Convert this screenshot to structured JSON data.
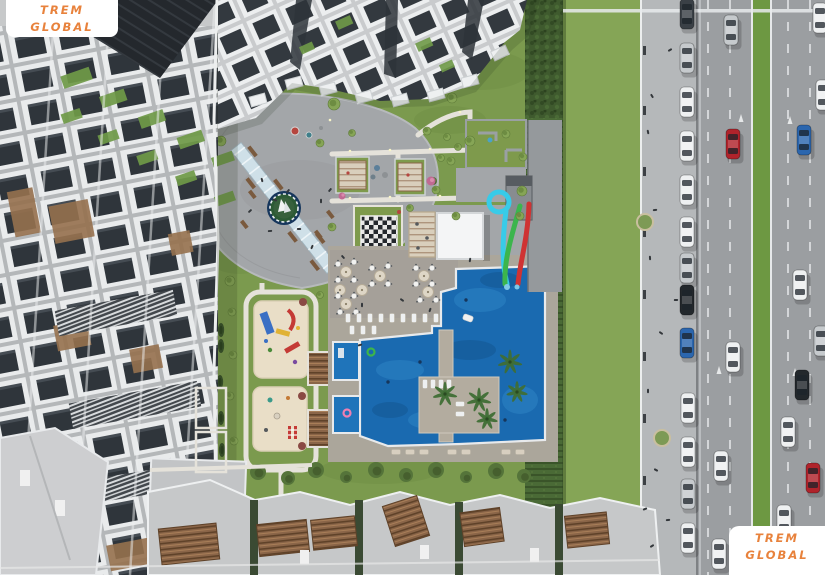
{
  "meta": {
    "description": "Aerial 3D architectural render of a residential complex: apartment blocks, landscaped courtyard with central plaza, chess board, playgrounds, cafe terrace, large swimming pool with water slides, hedge, sidewalk and multi-lane road with traffic",
    "width": 825,
    "height": 575
  },
  "watermarks": {
    "text_color": "#E8823C",
    "background": "#FFFFFF",
    "top_left": {
      "line1": "TREM",
      "line2": "GLOBAL"
    },
    "bottom_right": {
      "line1": "TREM",
      "line2": "GLOBAL"
    }
  },
  "palette": {
    "grass": "#7B9A4E",
    "grass_strip": "#85A556",
    "hedge": "#3F5A2E",
    "plaza": "#A3A6A9",
    "deck": "#ABA69B",
    "road": "#9B9EA1",
    "sidewalk": "#B5B8BA",
    "median": "#6D9842",
    "pool": "#1A6AB0",
    "slide_cyan": "#38CBE8",
    "slide_green": "#3CB54D",
    "slide_red": "#CF3333",
    "playground_sand": "#E9DEC7",
    "pergola_wood": "#8A6548",
    "car_colors": {
      "white": "#EEF0F1",
      "silver": "#C6CACD",
      "dark": "#3A4046",
      "black": "#23282C",
      "red": "#B0232B",
      "blue": "#2B66AE"
    }
  },
  "scene": {
    "cars": [
      {
        "x": 687,
        "y": 14,
        "c": "dark"
      },
      {
        "x": 687,
        "y": 58,
        "c": "silver"
      },
      {
        "x": 687,
        "y": 102,
        "c": "white"
      },
      {
        "x": 687,
        "y": 146,
        "c": "white"
      },
      {
        "x": 687,
        "y": 190,
        "c": "white"
      },
      {
        "x": 687,
        "y": 232,
        "c": "white"
      },
      {
        "x": 687,
        "y": 268,
        "c": "silver"
      },
      {
        "x": 687,
        "y": 300,
        "c": "black"
      },
      {
        "x": 687,
        "y": 343,
        "c": "blue"
      },
      {
        "x": 688,
        "y": 408,
        "c": "white"
      },
      {
        "x": 688,
        "y": 452,
        "c": "white"
      },
      {
        "x": 688,
        "y": 494,
        "c": "silver"
      },
      {
        "x": 688,
        "y": 538,
        "c": "white"
      },
      {
        "x": 731,
        "y": 30,
        "c": "silver"
      },
      {
        "x": 733,
        "y": 144,
        "c": "red"
      },
      {
        "x": 733,
        "y": 357,
        "c": "white"
      },
      {
        "x": 721,
        "y": 466,
        "c": "white"
      },
      {
        "x": 719,
        "y": 554,
        "c": "white"
      },
      {
        "x": 820,
        "y": 18,
        "c": "white"
      },
      {
        "x": 823,
        "y": 95,
        "c": "white"
      },
      {
        "x": 804,
        "y": 140,
        "c": "blue"
      },
      {
        "x": 800,
        "y": 285,
        "c": "white"
      },
      {
        "x": 821,
        "y": 341,
        "c": "silver"
      },
      {
        "x": 802,
        "y": 385,
        "c": "black"
      },
      {
        "x": 788,
        "y": 432,
        "c": "white"
      },
      {
        "x": 813,
        "y": 478,
        "c": "red"
      },
      {
        "x": 784,
        "y": 520,
        "c": "white"
      }
    ],
    "trees": [
      {
        "t": "tree",
        "x": 238,
        "y": 99,
        "r": 6
      },
      {
        "t": "tree",
        "x": 221,
        "y": 141,
        "r": 5
      },
      {
        "t": "tree",
        "x": 205,
        "y": 189,
        "r": 5
      },
      {
        "t": "tree",
        "x": 205,
        "y": 247,
        "r": 5
      },
      {
        "t": "tree",
        "x": 230,
        "y": 281,
        "r": 5
      },
      {
        "t": "tree",
        "x": 334,
        "y": 104,
        "r": 6
      },
      {
        "t": "tree",
        "x": 362,
        "y": 96,
        "r": 5
      },
      {
        "t": "tree",
        "x": 452,
        "y": 98,
        "r": 5
      },
      {
        "t": "tree",
        "x": 470,
        "y": 141,
        "r": 5
      },
      {
        "t": "tree",
        "x": 506,
        "y": 134,
        "r": 4
      },
      {
        "t": "tree",
        "x": 523,
        "y": 157,
        "r": 4
      },
      {
        "t": "tree",
        "x": 451,
        "y": 161,
        "r": 4
      },
      {
        "t": "tree",
        "x": 436,
        "y": 190,
        "r": 4
      },
      {
        "t": "tree",
        "x": 522,
        "y": 191,
        "r": 5
      },
      {
        "t": "tree",
        "x": 456,
        "y": 216,
        "r": 4
      },
      {
        "t": "tree",
        "x": 520,
        "y": 216,
        "r": 4
      },
      {
        "t": "tree",
        "x": 332,
        "y": 227,
        "r": 4
      },
      {
        "t": "tree",
        "x": 410,
        "y": 208,
        "r": 3.5
      },
      {
        "t": "tree",
        "x": 427,
        "y": 131,
        "r": 4
      },
      {
        "t": "tree",
        "x": 447,
        "y": 137,
        "r": 3.5
      },
      {
        "t": "tree",
        "x": 458,
        "y": 147,
        "r": 3.5
      },
      {
        "t": "tree",
        "x": 441,
        "y": 158,
        "r": 3.5
      },
      {
        "t": "tree",
        "x": 320,
        "y": 143,
        "r": 4
      },
      {
        "t": "tree",
        "x": 352,
        "y": 133,
        "r": 3.5
      },
      {
        "t": "tree",
        "x": 232,
        "y": 312,
        "r": 4
      },
      {
        "t": "tree",
        "x": 233,
        "y": 355,
        "r": 4
      },
      {
        "t": "tree",
        "x": 230,
        "y": 396,
        "r": 4
      },
      {
        "t": "tree",
        "x": 234,
        "y": 441,
        "r": 4
      },
      {
        "t": "tree",
        "x": 320,
        "y": 295,
        "r": 3.5
      },
      {
        "t": "cypress",
        "x": 221,
        "y": 330,
        "r": 7
      },
      {
        "t": "cypress",
        "x": 221,
        "y": 346,
        "r": 7
      },
      {
        "t": "cypress",
        "x": 220,
        "y": 382,
        "r": 7
      },
      {
        "t": "cypress",
        "x": 221,
        "y": 418,
        "r": 7
      },
      {
        "t": "cypress",
        "x": 222,
        "y": 450,
        "r": 7
      },
      {
        "t": "cypress",
        "x": 243,
        "y": 513,
        "r": 8
      },
      {
        "t": "cypress",
        "x": 246,
        "y": 543,
        "r": 8
      },
      {
        "t": "bush",
        "x": 258,
        "y": 472,
        "r": 8
      },
      {
        "t": "bush",
        "x": 288,
        "y": 478,
        "r": 7
      },
      {
        "t": "bush",
        "x": 316,
        "y": 470,
        "r": 8
      },
      {
        "t": "bush",
        "x": 346,
        "y": 477,
        "r": 6
      },
      {
        "t": "bush",
        "x": 376,
        "y": 470,
        "r": 8
      },
      {
        "t": "bush",
        "x": 406,
        "y": 475,
        "r": 7
      },
      {
        "t": "bush",
        "x": 436,
        "y": 470,
        "r": 8
      },
      {
        "t": "bush",
        "x": 466,
        "y": 477,
        "r": 6
      },
      {
        "t": "bush",
        "x": 496,
        "y": 471,
        "r": 8
      },
      {
        "t": "bush",
        "x": 524,
        "y": 476,
        "r": 7
      },
      {
        "t": "palm",
        "x": 445,
        "y": 394,
        "r": 8
      },
      {
        "t": "palm",
        "x": 479,
        "y": 400,
        "r": 8
      },
      {
        "t": "palm",
        "x": 510,
        "y": 362,
        "r": 8
      },
      {
        "t": "palm",
        "x": 517,
        "y": 392,
        "r": 7
      },
      {
        "t": "palm",
        "x": 487,
        "y": 419,
        "r": 7
      },
      {
        "t": "sidewalktree",
        "x": 645,
        "y": 222,
        "r": 8
      },
      {
        "t": "sidewalktree",
        "x": 662,
        "y": 438,
        "r": 8
      },
      {
        "t": "bush",
        "x": 433,
        "y": 181,
        "r": 4
      },
      {
        "t": "pink",
        "x": 431,
        "y": 181,
        "r": 4.5
      },
      {
        "t": "pink",
        "x": 342,
        "y": 196,
        "r": 3.5
      }
    ],
    "people": [
      [
        262,
        180
      ],
      [
        275,
        200
      ],
      [
        299,
        229
      ],
      [
        312,
        247
      ],
      [
        288,
        191
      ],
      [
        270,
        231
      ],
      [
        321,
        201
      ],
      [
        250,
        211
      ],
      [
        330,
        190
      ],
      [
        343,
        257
      ],
      [
        362,
        305
      ],
      [
        402,
        300
      ],
      [
        430,
        310
      ],
      [
        470,
        260
      ],
      [
        360,
        345
      ],
      [
        652,
        96
      ],
      [
        648,
        132
      ],
      [
        655,
        210
      ],
      [
        650,
        258
      ],
      [
        661,
        333
      ],
      [
        648,
        391
      ],
      [
        656,
        470
      ],
      [
        645,
        509
      ],
      [
        652,
        546
      ],
      [
        670,
        50
      ],
      [
        676,
        300
      ],
      [
        668,
        520
      ]
    ],
    "cafe_tables": [
      [
        338,
        264
      ],
      [
        354,
        262
      ],
      [
        338,
        280
      ],
      [
        354,
        280
      ],
      [
        338,
        296
      ],
      [
        354,
        296
      ],
      [
        340,
        312
      ],
      [
        356,
        312
      ],
      [
        372,
        268
      ],
      [
        388,
        266
      ],
      [
        372,
        284
      ],
      [
        388,
        284
      ],
      [
        416,
        268
      ],
      [
        432,
        268
      ],
      [
        416,
        284
      ],
      [
        432,
        284
      ],
      [
        420,
        300
      ],
      [
        436,
        300
      ]
    ],
    "umbrellas": [
      [
        346,
        272
      ],
      [
        346,
        304
      ],
      [
        380,
        276
      ],
      [
        424,
        276
      ],
      [
        428,
        292
      ],
      [
        362,
        290
      ],
      [
        340,
        290
      ]
    ],
    "loungers": [
      {
        "x": 348,
        "y": 318,
        "a": 0,
        "c": "w"
      },
      {
        "x": 359,
        "y": 318,
        "a": 0,
        "c": "w"
      },
      {
        "x": 370,
        "y": 318,
        "a": 0,
        "c": "w"
      },
      {
        "x": 381,
        "y": 318,
        "a": 0,
        "c": "w"
      },
      {
        "x": 392,
        "y": 318,
        "a": 0,
        "c": "w"
      },
      {
        "x": 403,
        "y": 318,
        "a": 0,
        "c": "w"
      },
      {
        "x": 414,
        "y": 318,
        "a": 0,
        "c": "w"
      },
      {
        "x": 425,
        "y": 318,
        "a": 0,
        "c": "w"
      },
      {
        "x": 436,
        "y": 318,
        "a": 0,
        "c": "w"
      },
      {
        "x": 352,
        "y": 330,
        "a": 0,
        "c": "w"
      },
      {
        "x": 363,
        "y": 330,
        "a": 0,
        "c": "w"
      },
      {
        "x": 374,
        "y": 330,
        "a": 0,
        "c": "w"
      },
      {
        "x": 425,
        "y": 384,
        "a": 0,
        "c": "w"
      },
      {
        "x": 433,
        "y": 384,
        "a": 0,
        "c": "w"
      },
      {
        "x": 441,
        "y": 384,
        "a": 0,
        "c": "w"
      },
      {
        "x": 449,
        "y": 384,
        "a": 0,
        "c": "w"
      },
      {
        "x": 460,
        "y": 404,
        "a": 90,
        "c": "w"
      },
      {
        "x": 460,
        "y": 414,
        "a": 90,
        "c": "w"
      },
      {
        "x": 396,
        "y": 452,
        "a": 90,
        "c": "t"
      },
      {
        "x": 410,
        "y": 452,
        "a": 90,
        "c": "t"
      },
      {
        "x": 424,
        "y": 452,
        "a": 90,
        "c": "t"
      },
      {
        "x": 452,
        "y": 452,
        "a": 90,
        "c": "t"
      },
      {
        "x": 466,
        "y": 452,
        "a": 90,
        "c": "t"
      },
      {
        "x": 506,
        "y": 452,
        "a": 90,
        "c": "t"
      },
      {
        "x": 520,
        "y": 452,
        "a": 90,
        "c": "t"
      }
    ],
    "pool_floats": [
      {
        "type": "ring",
        "x": 371,
        "y": 352,
        "c": "#3DB54A"
      },
      {
        "type": "ring",
        "x": 347,
        "y": 413,
        "c": "#EE7FB2"
      },
      {
        "type": "boat",
        "x": 468,
        "y": 318
      },
      {
        "type": "swimmer",
        "x": 388,
        "y": 382
      },
      {
        "type": "swimmer",
        "x": 420,
        "y": 362
      },
      {
        "type": "swimmer",
        "x": 466,
        "y": 300
      },
      {
        "type": "swimmer",
        "x": 505,
        "y": 420
      }
    ]
  }
}
